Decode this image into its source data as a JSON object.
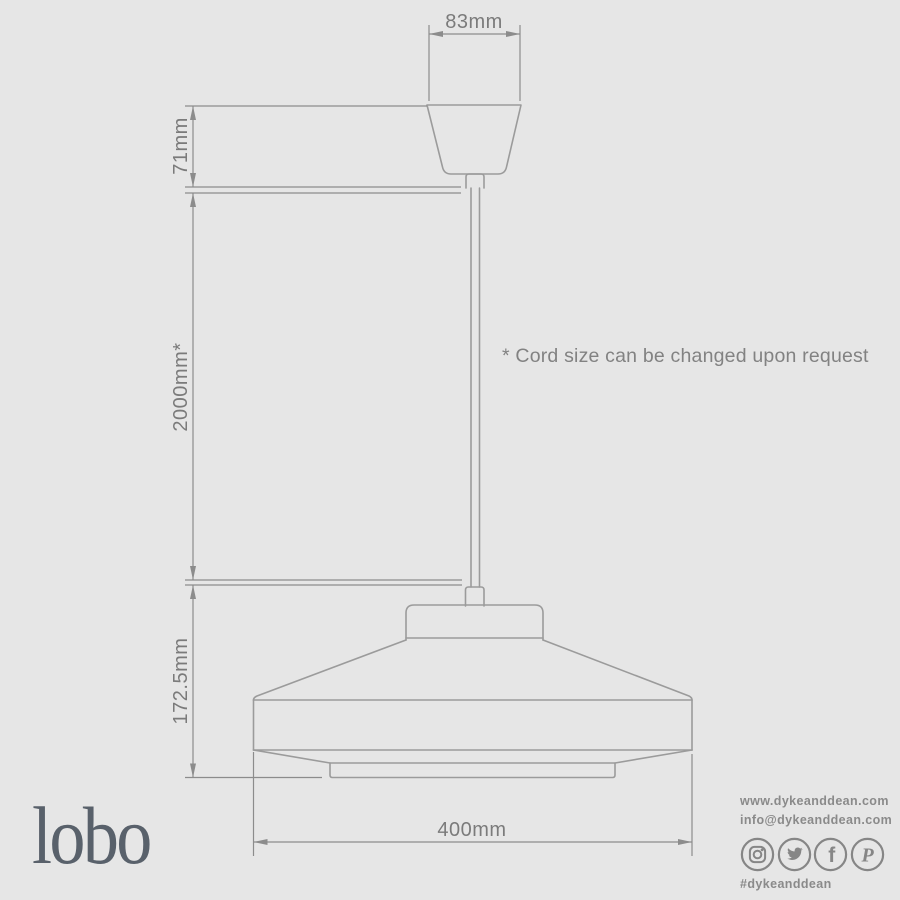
{
  "dimensions": {
    "canopy_width": "83mm",
    "canopy_height": "71mm",
    "cord_length": "2000mm*",
    "shade_height": "172.5mm",
    "shade_diameter": "400mm"
  },
  "note": "* Cord size can be changed upon request",
  "logo": "lobo",
  "contact": {
    "website": "www.dykeanddean.com",
    "email": "info@dykeanddean.com",
    "hashtag": "#dykeanddean",
    "social_icons": [
      "instagram",
      "twitter",
      "facebook",
      "pinterest"
    ],
    "glyphs": {
      "facebook": "f",
      "pinterest": "P"
    }
  },
  "colors": {
    "background": "#e6e6e6",
    "drawing_line": "#9b9b9b",
    "dimension_line": "#8c8c8c",
    "dimension_text": "#7b7b7b",
    "note_text": "#828282",
    "logo_text": "#59616b",
    "contact_text": "#8a8a8a",
    "icon": "#868686"
  }
}
